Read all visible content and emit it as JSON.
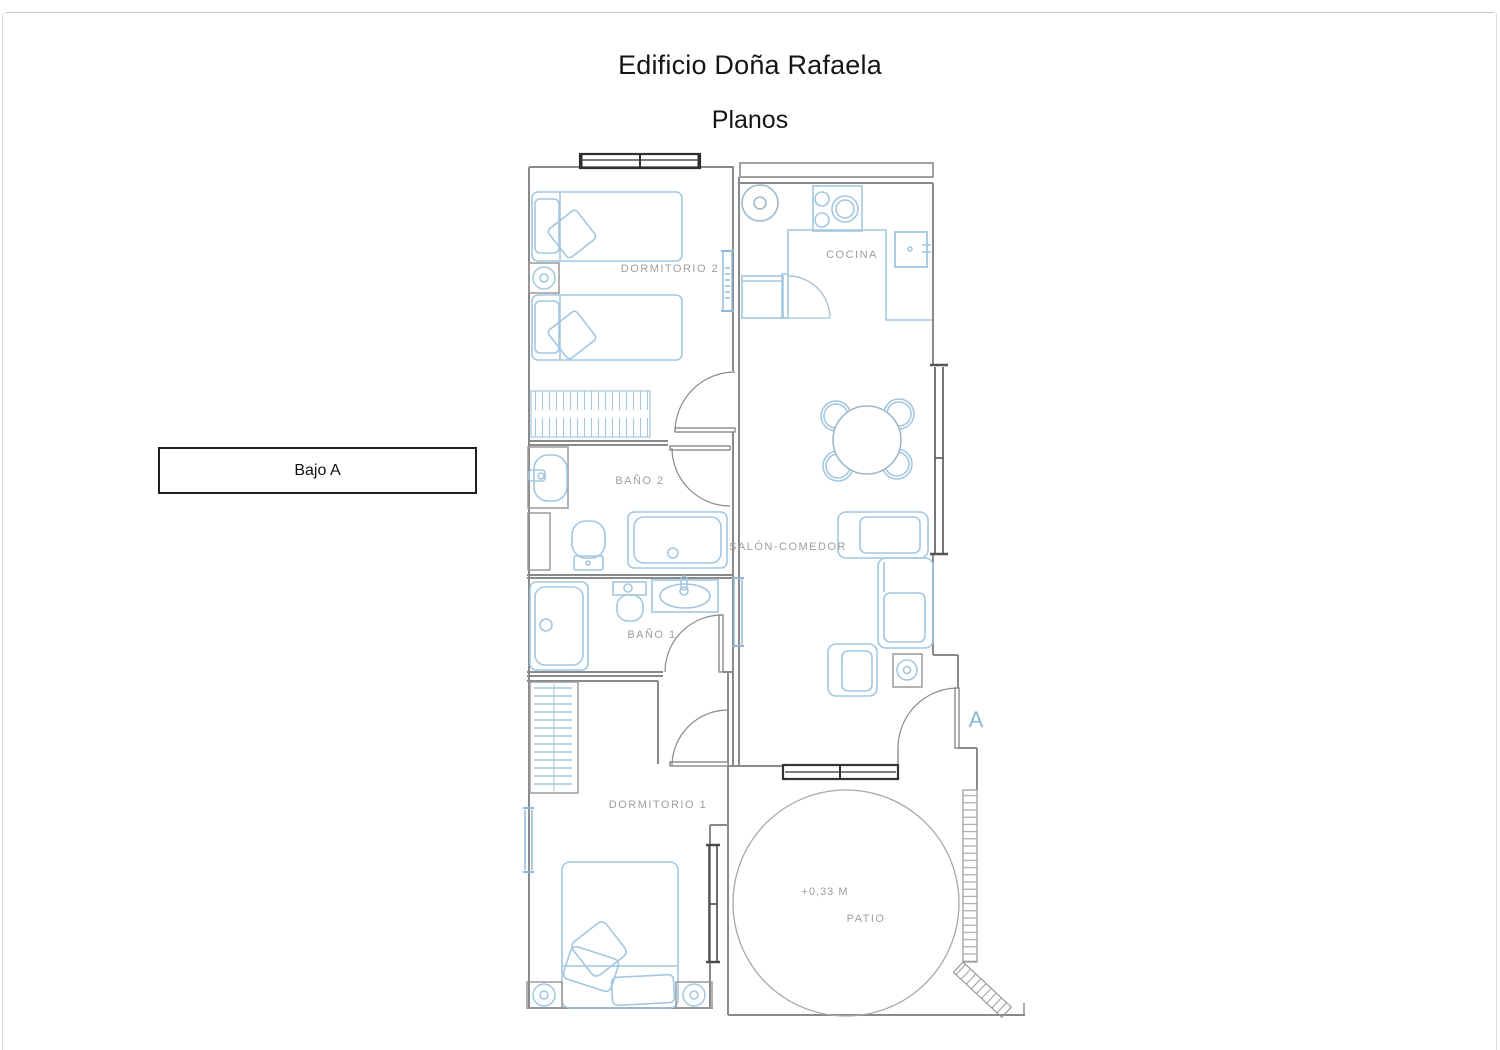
{
  "page": {
    "title": "Edificio Doña Rafaela",
    "subtitle": "Planos"
  },
  "floor_label": "Bajo A",
  "plan": {
    "rooms": [
      {
        "label": "DORMITORIO 2"
      },
      {
        "label": "COCINA"
      },
      {
        "label": "BAÑO 2"
      },
      {
        "label": "SALÓN-COMEDOR"
      },
      {
        "label": "BAÑO 1"
      },
      {
        "label": "DORMITORIO 1"
      },
      {
        "label": "PATIO"
      }
    ],
    "annotations": {
      "patio_level": "+0,33 M",
      "section_marker": "A"
    },
    "colors": {
      "wall": "#8a8a8a",
      "furniture": "#a3c7e0",
      "window": "#3a3a3a",
      "label": "#9e9e9e",
      "marker_blue": "#84b7d8"
    }
  }
}
